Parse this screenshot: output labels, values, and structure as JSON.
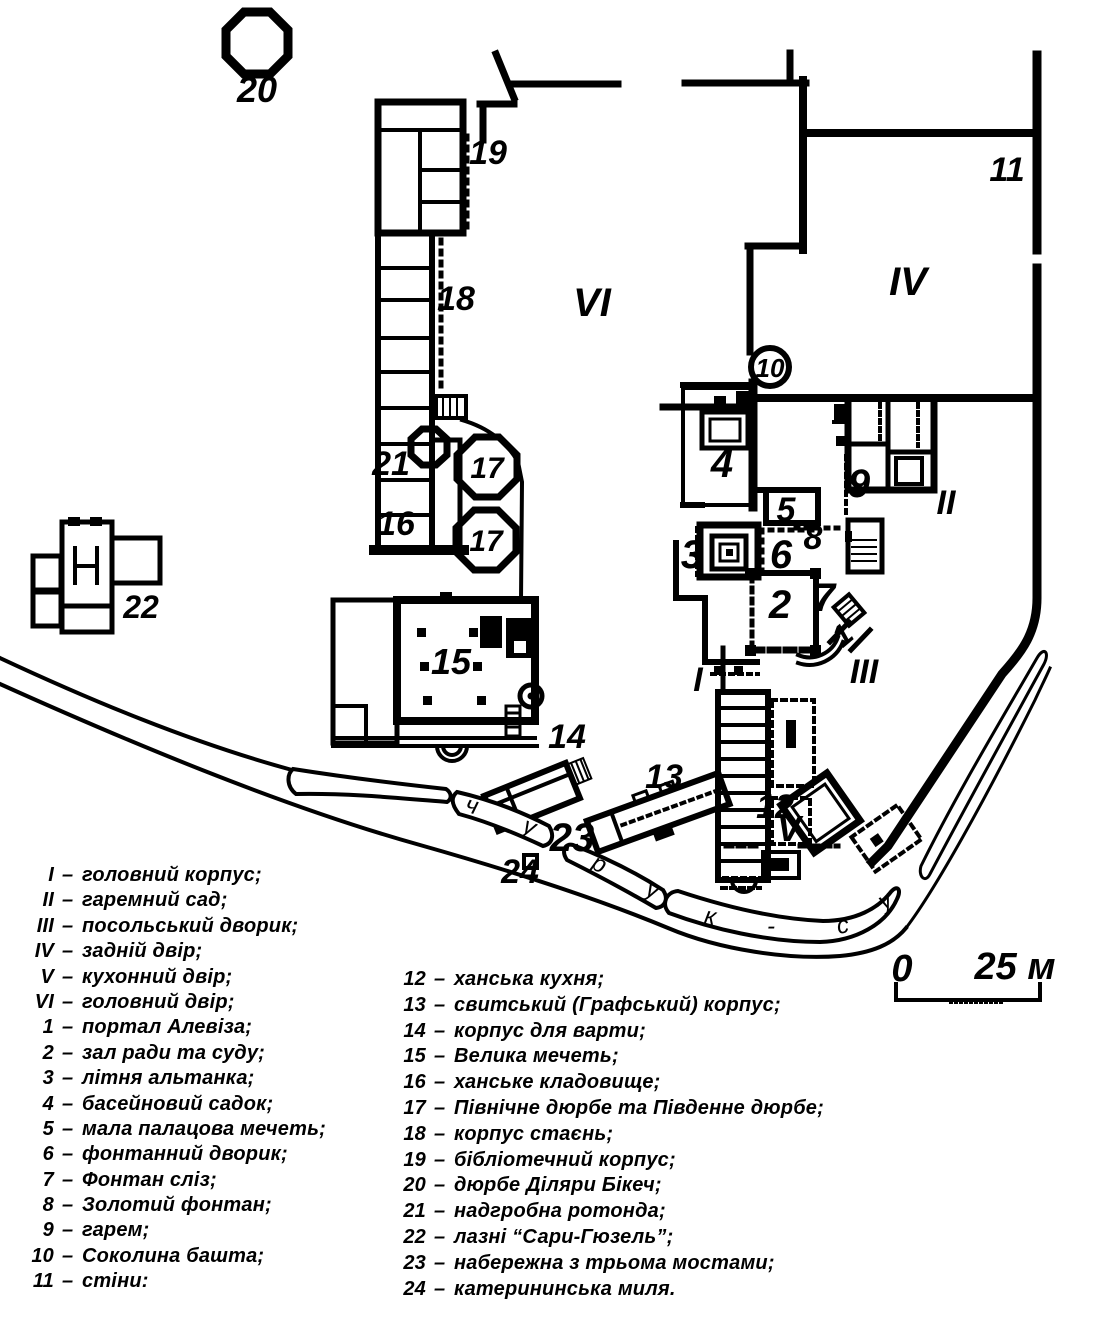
{
  "map": {
    "labels": {
      "n1": "1",
      "n2": "2",
      "n3": "3",
      "n4": "4",
      "n5": "5",
      "n6": "6",
      "n7": "7",
      "n8": "8",
      "n9": "9",
      "n10": "10",
      "n11": "11",
      "n12": "12",
      "n13": "13",
      "n14": "14",
      "n15": "15",
      "n16": "16",
      "n17": "17",
      "n18": "18",
      "n19": "19",
      "n20": "20",
      "n21": "21",
      "n22": "22",
      "n23": "23",
      "n24": "24",
      "rI": "I",
      "rII": "II",
      "rIII": "III",
      "rIV": "IV",
      "rV": "V",
      "rVI": "VI"
    },
    "river_letters": [
      "ч",
      "у",
      "р",
      "у",
      "к",
      "-",
      "с",
      "у"
    ],
    "scale": {
      "zero": "0",
      "max": "25 м"
    }
  },
  "legend": {
    "dash": "–",
    "left": [
      {
        "num": "I",
        "text": "головний корпус;"
      },
      {
        "num": "II",
        "text": "гаремний сад;"
      },
      {
        "num": "III",
        "text": "посольський дворик;"
      },
      {
        "num": "IV",
        "text": "задній двір;"
      },
      {
        "num": "V",
        "text": "кухонний двір;"
      },
      {
        "num": "VI",
        "text": "головний двір;"
      },
      {
        "num": "1",
        "text": "портал Алевіза;"
      },
      {
        "num": "2",
        "text": "зал ради та суду;"
      },
      {
        "num": "3",
        "text": "літня альтанка;"
      },
      {
        "num": "4",
        "text": "басейновий садок;"
      },
      {
        "num": "5",
        "text": "мала палацова мечеть;"
      },
      {
        "num": "6",
        "text": "фонтанний дворик;"
      },
      {
        "num": "7",
        "text": "Фонтан сліз;"
      },
      {
        "num": "8",
        "text": "Золотий фонтан;"
      },
      {
        "num": "9",
        "text": "гарем;"
      },
      {
        "num": "10",
        "text": "Соколина башта;"
      },
      {
        "num": "11",
        "text": "стіни:"
      }
    ],
    "right": [
      {
        "num": "12",
        "text": "ханська кухня;"
      },
      {
        "num": "13",
        "text": "свитський (Графський) корпус;"
      },
      {
        "num": "14",
        "text": "корпус для варти;"
      },
      {
        "num": "15",
        "text": "Велика мечеть;"
      },
      {
        "num": "16",
        "text": "ханське кладовище;"
      },
      {
        "num": "17",
        "text": "Північне дюрбе та Південне дюрбе;"
      },
      {
        "num": "18",
        "text": "корпус стаєнь;"
      },
      {
        "num": "19",
        "text": "бібліотечний корпус;"
      },
      {
        "num": "20",
        "text": "дюрбе Діляри Бікеч;"
      },
      {
        "num": "21",
        "text": "надгробна ротонда;"
      },
      {
        "num": "22",
        "text": "лазні “Сари-Гюзель”;"
      },
      {
        "num": "23",
        "text": "набережна з трьома мостами;"
      },
      {
        "num": "24",
        "text": "катерининська миля."
      }
    ]
  },
  "colors": {
    "ink": "#000000",
    "paper": "#ffffff"
  }
}
